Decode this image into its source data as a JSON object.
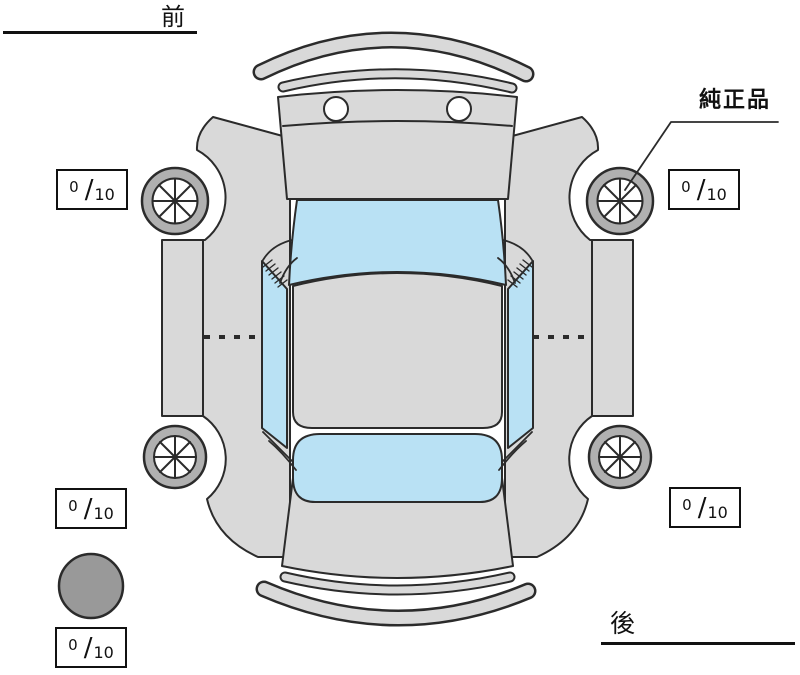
{
  "labels": {
    "front": "前",
    "rear": "後",
    "genuine_part": "純正品"
  },
  "tread_slash": "/",
  "tread_boxes": [
    {
      "id": "front-left",
      "value": "0",
      "max": "10"
    },
    {
      "id": "front-right",
      "value": "0",
      "max": "10"
    },
    {
      "id": "rear-left",
      "value": "0",
      "max": "10"
    },
    {
      "id": "rear-right",
      "value": "0",
      "max": "10"
    },
    {
      "id": "spare",
      "value": "0",
      "max": "10"
    }
  ],
  "colors": {
    "body_gray": "#d9d9d9",
    "window_blue": "#b9e1f4",
    "tire_gray": "#b0b0b0",
    "spare_gray": "#999999",
    "line_dark": "#2b2b2b",
    "label_black": "#111111"
  }
}
